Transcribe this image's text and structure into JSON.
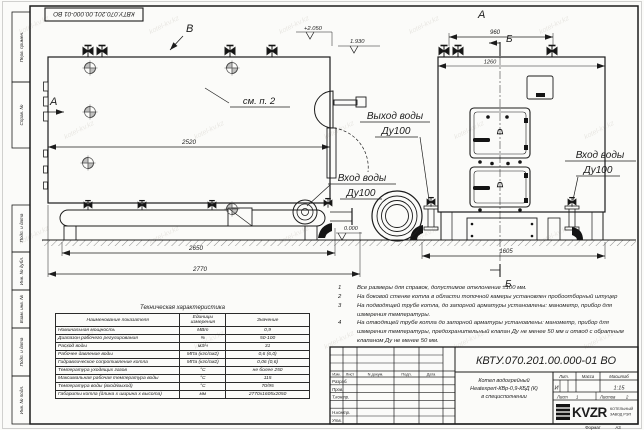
{
  "watermark": "kotel-kv.kz",
  "frame": {
    "top_stamp": "КВТУ.070.201.00.000-01 ВО",
    "side_labels": [
      "Перв. примен.",
      "Справ. №",
      "Подп. и дата",
      "Инв. № дубл.",
      "Взам. инв. №",
      "Подп. и дата",
      "Инв. № подл."
    ]
  },
  "views": {
    "side": {
      "label_v": "В",
      "label_a": "А",
      "see_note": "см. п. 2",
      "dim_2520": "2520",
      "dim_2650": "2650",
      "dim_2770": "2770",
      "elev_top": "+2.050",
      "elev_mid": "1.930",
      "elev_zero": "0.000",
      "inlet_line1": "Вход воды",
      "inlet_line2": "Ду100"
    },
    "front": {
      "label_a": "А",
      "label_b_top": "Б",
      "label_b_bottom": "Б",
      "dim_960": "960",
      "dim_1260": "1260",
      "dim_1605": "1605",
      "outlet_line1": "Выход воды",
      "outlet_line2": "Ду100",
      "inlet_line1": "Вход воды",
      "inlet_line2": "Ду100"
    }
  },
  "notes": [
    {
      "num": "1",
      "text": "Все размеры для справок, допустимое отклонение  ±100 мм."
    },
    {
      "num": "2",
      "text": "На боковой стенке котла в области топочной камеры установлен пробоотборный штуцер"
    },
    {
      "num": "3",
      "text": "На  подводящей трубе котла, до запорной арматуры установлены: манометр, прибор для измерения температуры."
    },
    {
      "num": "4",
      "text": "На отводящей трубе котла до запорной арматуры установлены: манометр, прибор для измерения температуры, предохранительный клапан Ду не менее 50 мм и отвод с обратным клапаном Ду не менее 50 мм."
    }
  ],
  "spec_table": {
    "title": "Техническая характеристика",
    "headers": [
      "Наименование показателя",
      "Единицы измерения",
      "Значение"
    ],
    "rows": [
      [
        "Номинальная мощность",
        "МВт",
        "0,9"
      ],
      [
        "Диапазон рабочего регулирования",
        "%",
        "50-100"
      ],
      [
        "Расход воды",
        "м3/ч",
        "31"
      ],
      [
        "Рабочее давление воды",
        "МПа (кгс/см2)",
        "0,6 (6,0)"
      ],
      [
        "Гидравлическое сопротивление котла",
        "МПа (кгс/см2)",
        "0,06 (0,6)"
      ],
      [
        "Температура уходящих газов",
        "°С",
        "не более 250"
      ],
      [
        "Максимальная рабочая температура воды",
        "°С",
        "115"
      ],
      [
        "Температура воды (вход/выход)",
        "°С",
        "70/95"
      ],
      [
        "Габариты котла (длина х ширина х высота)",
        "мм",
        "2770х1605х2050"
      ]
    ]
  },
  "title_block": {
    "doc_number": "КВТУ.070.201.00.000-01 ВО",
    "product_name_line1": "Котел водогрейный",
    "product_name_line2": "Heatexpert-КВр-0,9-КБД (К)",
    "product_name_line3": "в специсполнении",
    "header_cols": [
      "Изм.",
      "Лист",
      "N докум.",
      "Подп.",
      "Дата"
    ],
    "row_labels": [
      "Разраб.",
      "Пров.",
      "Т.контр.",
      "",
      "Н.контр.",
      "Утв."
    ],
    "lit_header": "Лит.",
    "mass_header": "Масса",
    "scale_header": "Масштаб",
    "lit_value": "И",
    "scale_value": "1:15",
    "sheet_label": "Лист",
    "sheet_value": "1",
    "sheets_label": "Листов",
    "sheets_value": "2",
    "logo_text": "KVZR",
    "logo_sub1": "КОТЕЛЬНЫЙ",
    "logo_sub2": "ЗАВОД РЭП",
    "format_label": "Формат",
    "format_value": "А3"
  }
}
